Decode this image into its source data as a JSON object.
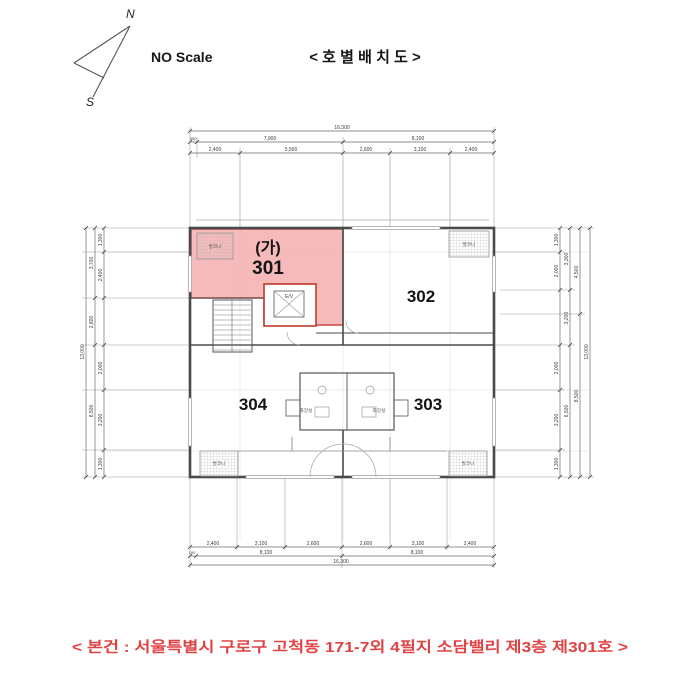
{
  "header": {
    "north_label": "N",
    "south_label": "S",
    "scale_note": "NO Scale",
    "title": "< 호 별 배 치 도 >"
  },
  "units": {
    "mark": "(가)",
    "u301": "301",
    "u302": "302",
    "u303": "303",
    "u304": "304"
  },
  "rooms": {
    "balcony": "발코니",
    "toilet": "화장실",
    "elevator": "E/V"
  },
  "dims": {
    "top": {
      "total": "16,300",
      "row2": [
        "300",
        "7,900",
        "8,100"
      ],
      "row3": [
        "2,400",
        "5,500",
        "2,600",
        "3,100",
        "2,400"
      ]
    },
    "bottom": {
      "row1": [
        "2,400",
        "3,100",
        "2,600",
        "2,600",
        "3,100",
        "2,400"
      ],
      "row2": [
        "100",
        "8,100",
        "8,100"
      ],
      "total": "16,300"
    },
    "left": {
      "inner": [
        "1,300",
        "2,400",
        "2,000",
        "3,200",
        "1,300"
      ],
      "mid": [
        "3,700",
        "2,800",
        "6,500"
      ],
      "total": "13,000"
    },
    "right": {
      "inner": [
        "1,300",
        "2,000",
        "2,000",
        "3,200",
        "1,300"
      ],
      "mid": [
        "3,300",
        "3,200",
        "6,500"
      ],
      "outer": [
        "4,500",
        "8,500"
      ],
      "total": "13,000"
    }
  },
  "caption": "< 본건 : 서울특별시 구로구 고척동 171-7외 4필지 소담밸리 제3층 제301호 >",
  "colors": {
    "highlight": "#F2A0A0",
    "highlight_border": "#C74B4B",
    "core_red": "#C0392B",
    "caption_red": "#E04343",
    "wall": "#4A4A4A"
  }
}
